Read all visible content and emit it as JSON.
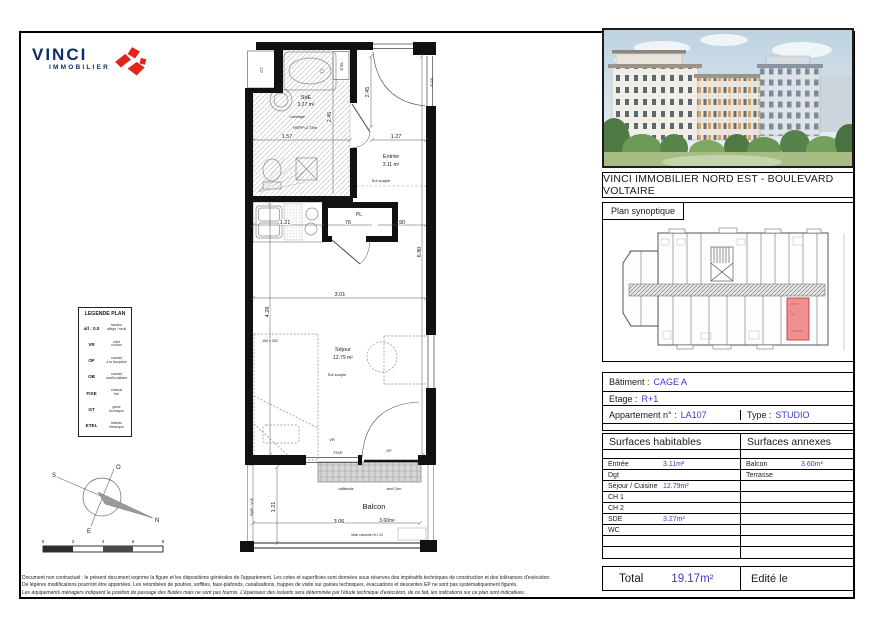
{
  "logo": {
    "brand": "VINCI",
    "division": "IMMOBILIER"
  },
  "plan": {
    "gt": "GT",
    "etel": "ETEL",
    "pl": "PL",
    "vr": "VR",
    "fixe": "FIXE",
    "of": "OF",
    "p100": "P.100",
    "sde_name": "SdE",
    "sde_area": "3.27 m²",
    "carrelage": "Carrelage",
    "hsfp": "HSFP=2.75m",
    "entree_name": "Entrée",
    "entree_area": "3.11 m²",
    "sol_souple": "Sol souple",
    "sejour_name": "Séjour",
    "sejour_area": "12.79 m²",
    "bed_size": "180 x 200",
    "balcon_name": "Balcon",
    "balcon_area": "3.60m²",
    "caillebotis": "caillebotis",
    "seuil": "seuil 2cm",
    "pare_vue": "PARE - VUE",
    "main_courante": "Main courante Ht 1.10",
    "d157": "1.57",
    "d245": "2.45",
    "d127": "1.27",
    "d121": "1.21",
    "d76": "76",
    "d90": "90",
    "d680": "6.80",
    "d301": "3.01",
    "d428": "4.28",
    "d306": "3.06"
  },
  "legend": {
    "title": "LEGENDE PLAN",
    "rows": [
      {
        "code": "all : 0.0",
        "desc": "hauteur\nallège / seuil"
      },
      {
        "code": "VR",
        "desc": "volet\nroulant"
      },
      {
        "code": "OF",
        "desc": "ouvrant\nà la française"
      },
      {
        "code": "OB",
        "desc": "ouvrant\noscillo-battant"
      },
      {
        "code": "FIXE",
        "desc": "chassis\nfixe"
      },
      {
        "code": "GT",
        "desc": "gaine\ntechnique"
      },
      {
        "code": "ETEL",
        "desc": "tableau\nélectrique"
      }
    ]
  },
  "compass": {
    "n": "N",
    "s": "S",
    "e": "E",
    "o": "O"
  },
  "scalebar": {
    "t0": "0",
    "t2": "2",
    "t4": "4",
    "t6": "6",
    "t8": "8"
  },
  "right": {
    "title": "VINCI IMMOBILIER NORD EST - BOULEVARD VOLTAIRE",
    "synoptique_label": "Plan synoptique",
    "info": {
      "batiment_label": "Bâtiment :",
      "batiment_value": "CAGE A",
      "etage_label": "Etage :",
      "etage_value": "R+1",
      "appart_label": "Appartement n° :",
      "appart_value": "LA107",
      "type_label": "Type :",
      "type_value": "STUDIO"
    },
    "surfaces": {
      "left_header": "Surfaces habitables",
      "right_header": "Surfaces annexes",
      "habitables": [
        {
          "label": "Entrée",
          "value": "3.11m²"
        },
        {
          "label": "Dgt",
          "value": ""
        },
        {
          "label": "Séjour / Cuisine",
          "value": "12.79m²"
        },
        {
          "label": "CH 1",
          "value": ""
        },
        {
          "label": "CH 2",
          "value": ""
        },
        {
          "label": "SDE",
          "value": "3.27m²"
        },
        {
          "label": "WC",
          "value": ""
        },
        {
          "label": "",
          "value": ""
        },
        {
          "label": "",
          "value": ""
        }
      ],
      "annexes": [
        {
          "label": "Balcon",
          "value": "3.60m²"
        },
        {
          "label": "Terrasse",
          "value": ""
        },
        {
          "label": "",
          "value": ""
        },
        {
          "label": "",
          "value": ""
        },
        {
          "label": "",
          "value": ""
        },
        {
          "label": "",
          "value": ""
        },
        {
          "label": "",
          "value": ""
        },
        {
          "label": "",
          "value": ""
        },
        {
          "label": "",
          "value": ""
        }
      ]
    },
    "total": {
      "label": "Total",
      "value": "19.17m²",
      "edited": "Edité le"
    }
  },
  "disclaimer": {
    "line1": "Document non contractuel : le présent document exprime la figure et les dispositions générales de l'appartement. Les cotes et superficies sont données sous réserves des impératifs techniques de construction et des tolérances d'exécution.",
    "line2": "De légères modifications pourront être apportées. Les retombées de poutres, soffites, faux-plafonds, canalisations, trappes de visite sur gaines techniques, évacuations et descentes EP ne sont pas systématiquement figurés.",
    "line3": "Les équipements ménagers indiquent la position de passage des fluides mais ne sont pas fournis. L'épaisseur des isolants sera déterminée par l'étude technique d'exécution, de ce fait, les indications sur ce plan sont indicatives."
  },
  "colors": {
    "accent_blue": "#3a3ac6",
    "vinci_navy": "#0b2d6b",
    "vinci_red": "#e0251b",
    "unit_red": "#f19090"
  }
}
